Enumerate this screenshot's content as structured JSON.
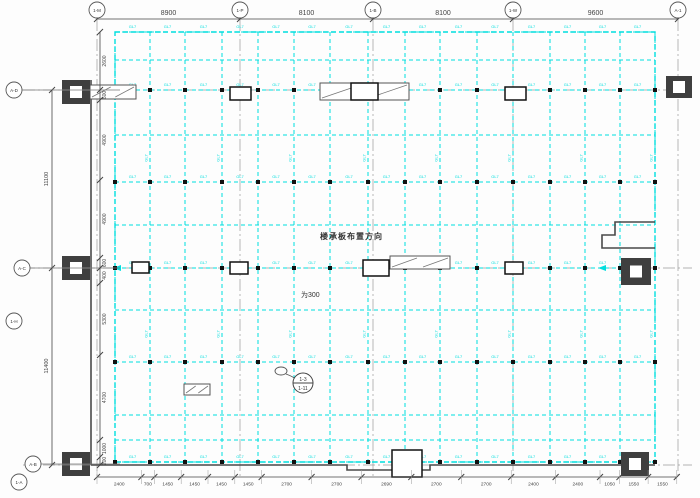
{
  "drawing": {
    "annotation_direction": "楼承板布置方向",
    "annotation_thickness": "为300",
    "beam_label": "GL7",
    "detail_callout": {
      "top": "1-3",
      "bottom": "1-11"
    },
    "colors": {
      "beam": "#00dede",
      "dim": "#444444",
      "axis": "#999999",
      "column_fill": "#3f3f3f",
      "outline": "#4a4a4a",
      "node": "#111111"
    },
    "top_axes": {
      "x": [
        97,
        240,
        373,
        513,
        678
      ],
      "labels": [
        "1-M",
        "1-P",
        "1-B",
        "1-W",
        "A-1"
      ],
      "dims": [
        "8900",
        "8100",
        "8100",
        "9600"
      ]
    },
    "left_bubbles": [
      {
        "label": "A-D",
        "x": 14,
        "y": 90,
        "leader": true
      },
      {
        "label": "A-C",
        "x": 22,
        "y": 268,
        "leader": true
      },
      {
        "label": "1-H",
        "x": 14,
        "y": 321,
        "leader": false
      },
      {
        "label": "A-B",
        "x": 33,
        "y": 464,
        "leader": true
      },
      {
        "label": "1-A",
        "x": 19,
        "y": 482,
        "leader": false
      }
    ],
    "axis_rows_y": [
      90,
      268,
      465
    ],
    "left_outer_dims": {
      "line_x": 52,
      "ticks": [
        90,
        268,
        465
      ],
      "labels": [
        {
          "text": "11100",
          "y": 179
        },
        {
          "text": "11400",
          "y": 366
        }
      ]
    },
    "left_inner_dims": {
      "line_x": 100,
      "ticks": [
        32,
        90,
        100,
        180,
        258,
        268,
        283,
        355,
        440,
        457,
        465
      ],
      "labels": [
        "2600",
        "600",
        "4900",
        "4900",
        "600",
        "400",
        "5300",
        "4700",
        "1000",
        "200"
      ]
    },
    "bottom_dims": {
      "line_y": 477,
      "start_x": 97,
      "scale": 0.0185,
      "values": [
        2400,
        700,
        1450,
        1450,
        1450,
        1450,
        2700,
        2700,
        2690,
        2700,
        2700,
        2400,
        2400,
        1050,
        1550,
        1550
      ]
    },
    "deck": {
      "bounds": {
        "x1": 115,
        "y1": 32,
        "x2": 655,
        "y2": 462
      },
      "v_beams": [
        115,
        150,
        185,
        222,
        258,
        294,
        330,
        368,
        405,
        440,
        477,
        513,
        550,
        585,
        620,
        655
      ],
      "h_beams": [
        32,
        60,
        90,
        135,
        182,
        225,
        268,
        310,
        362,
        415,
        440,
        462
      ],
      "node_rows": [
        90,
        182,
        268,
        362,
        462
      ],
      "label_rows": [
        28,
        86,
        178,
        264,
        358,
        458
      ],
      "v_label_ys": [
        158,
        334
      ]
    },
    "outline_paths": [
      "M91,80 L91,465",
      "M91,465 L347,465 L347,470 L430,470 L430,465 L655,465",
      "M655,222 L615,222 L615,235 L602,235 L602,248 L655,248"
    ],
    "columns_filled": [
      {
        "x": 62,
        "y": 80,
        "w": 28,
        "h": 24
      },
      {
        "x": 666,
        "y": 76,
        "w": 26,
        "h": 22
      },
      {
        "x": 62,
        "y": 256,
        "w": 28,
        "h": 24
      },
      {
        "x": 621,
        "y": 258,
        "w": 30,
        "h": 27
      },
      {
        "x": 62,
        "y": 452,
        "w": 28,
        "h": 24
      },
      {
        "x": 621,
        "y": 452,
        "w": 28,
        "h": 24
      }
    ],
    "columns_open": [
      {
        "x": 230,
        "y": 87,
        "w": 21,
        "h": 13
      },
      {
        "x": 351,
        "y": 83,
        "w": 27,
        "h": 17
      },
      {
        "x": 505,
        "y": 87,
        "w": 21,
        "h": 13
      },
      {
        "x": 132,
        "y": 262,
        "w": 17,
        "h": 11
      },
      {
        "x": 230,
        "y": 262,
        "w": 18,
        "h": 12
      },
      {
        "x": 363,
        "y": 260,
        "w": 26,
        "h": 16
      },
      {
        "x": 505,
        "y": 262,
        "w": 18,
        "h": 12
      },
      {
        "x": 392,
        "y": 450,
        "w": 30,
        "h": 27
      }
    ],
    "plates": [
      {
        "x": 90,
        "y": 85,
        "w": 46,
        "h": 14
      },
      {
        "x": 320,
        "y": 83,
        "w": 89,
        "h": 17
      },
      {
        "x": 390,
        "y": 256,
        "w": 60,
        "h": 13
      },
      {
        "x": 184,
        "y": 384,
        "w": 26,
        "h": 11
      }
    ]
  }
}
